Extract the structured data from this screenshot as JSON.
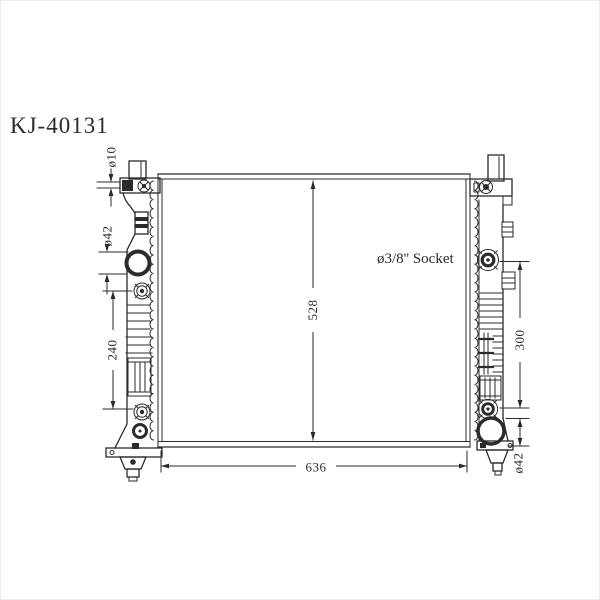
{
  "drawing": {
    "title": "KJ-40131",
    "annotation": "ø3/8'' Socket",
    "dims": {
      "pin_diameter": "ø10",
      "inlet_diameter": "ø42",
      "left_port_span": "240",
      "core_height": "528",
      "right_port_span": "300",
      "overall_width": "636",
      "outlet_diameter": "ø42"
    },
    "colors": {
      "line": "#2b2b2b",
      "background": "#ffffff"
    }
  }
}
